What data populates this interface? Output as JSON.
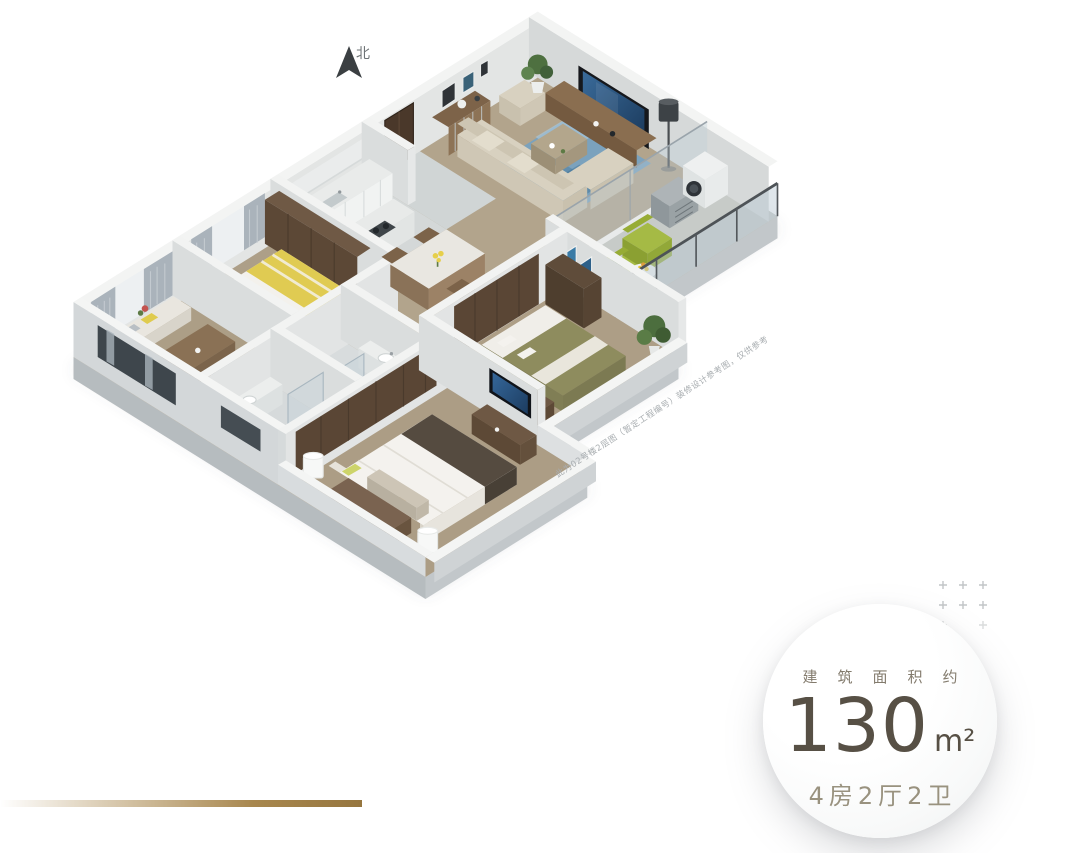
{
  "compass": {
    "label": "北"
  },
  "badge": {
    "area_label": "建筑面积约",
    "area_value": "130",
    "area_unit": "m²",
    "layout_label": "4房2厅2卫",
    "value_color": "#575045",
    "label_color": "#837b6d",
    "layout_color": "#99927f",
    "background": "#ffffff"
  },
  "disclaimer": {
    "text": "此为02号楼2层图（暂定工程编号）装修设计参考图，仅供参考"
  },
  "decor": {
    "gold_line_color": "#a8874e",
    "plus_color": "#c2c5c7",
    "compass_color": "#3b3f42"
  }
}
